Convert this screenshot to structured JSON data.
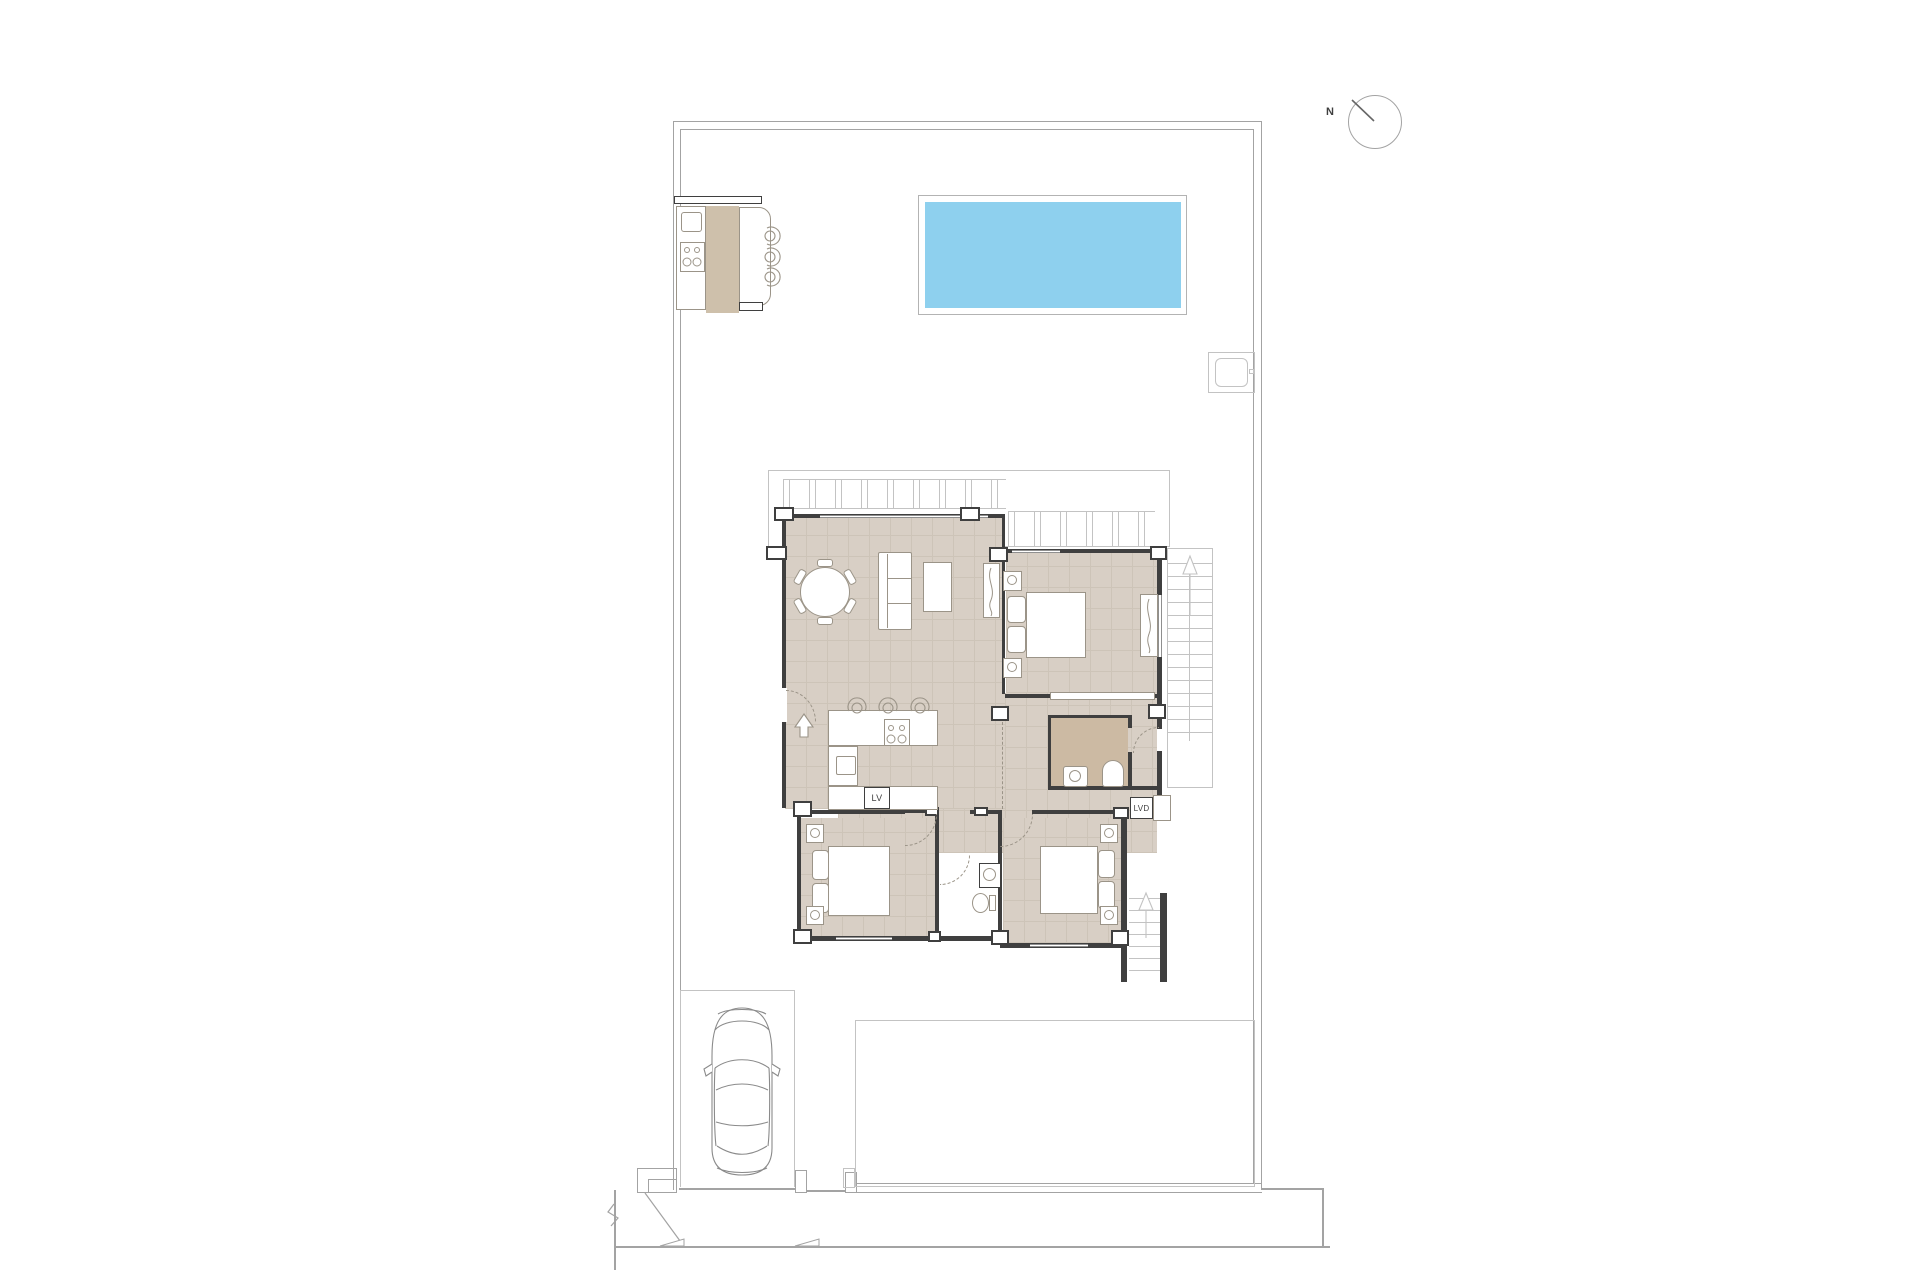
{
  "compass": {
    "north_label": "N"
  },
  "labels": {
    "dishwasher": "LV",
    "laundry": "LVD"
  },
  "colors": {
    "pool_water": "#8ed0ee",
    "floor": "#d8cfc5",
    "floor_grid": "#cdc4b8",
    "floor_dark": "#ccbaa3",
    "counter_tan": "#cec0ab",
    "wall": "#3f3f3f",
    "furn": "#9b9488",
    "site": "#a3a3a3",
    "thin": "#c3c3c3",
    "text": "#3f3f3f"
  }
}
